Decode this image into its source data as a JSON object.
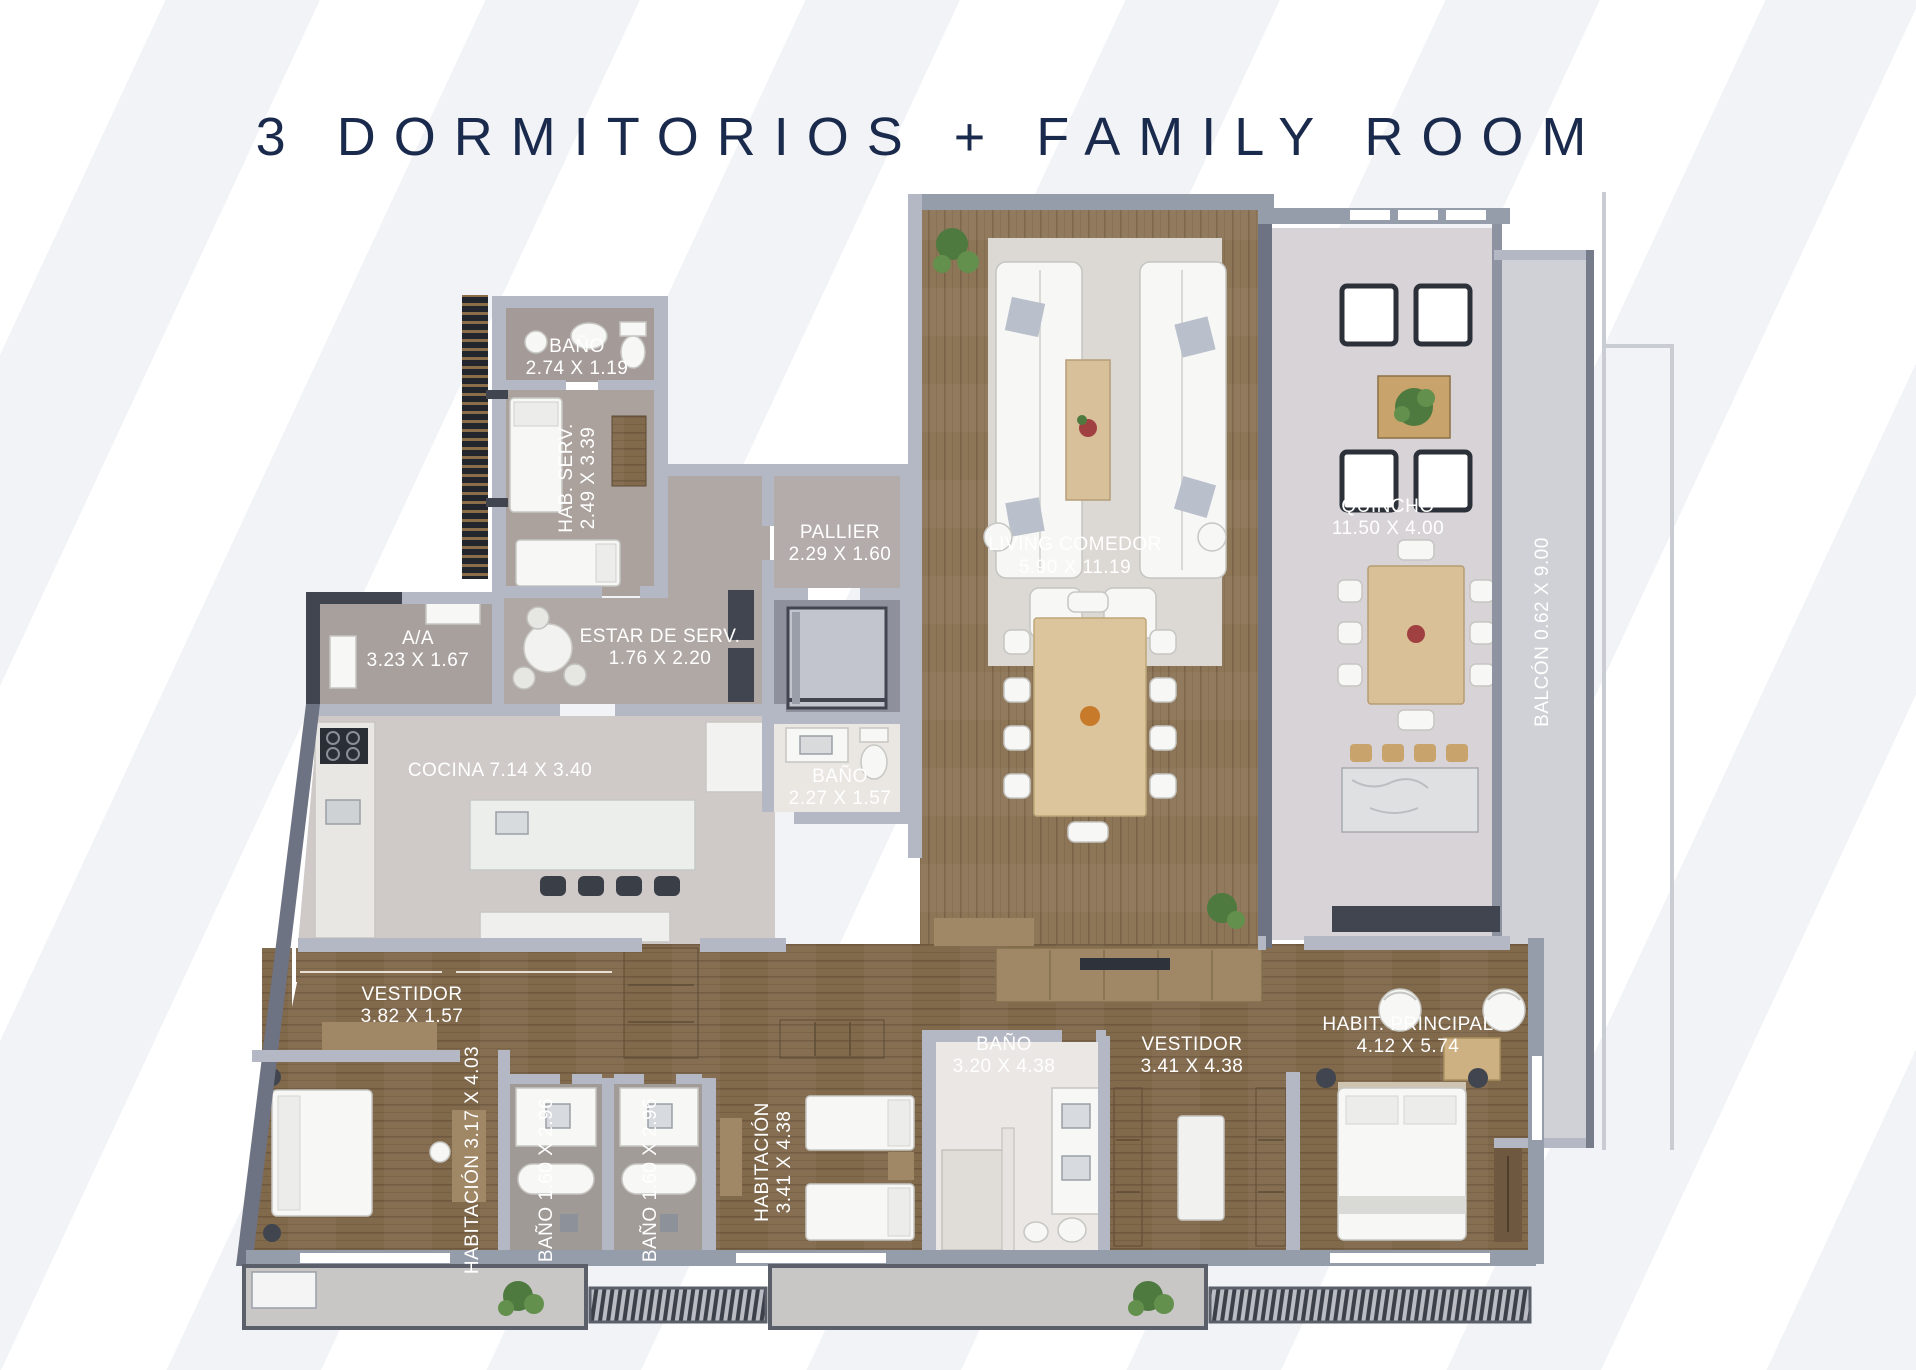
{
  "title": "3 DORMITORIOS + FAMILY ROOM",
  "colors": {
    "title_text": "#1a2a4c",
    "label_text": "#ffffff",
    "wood_floor": "#8d7557",
    "light_floor": "#d7d3d6",
    "stone_floor": "#cfcac8",
    "wall_light": "#b4b8c4",
    "wall_dark": "#6d7382",
    "background_stripe": "#f2f3f6"
  },
  "rooms": {
    "bano_serv": {
      "name": "BAÑO",
      "dims": "2.74 X 1.19"
    },
    "hab_serv": {
      "name": "HAB. SERV.",
      "dims": "2.49 X 3.39"
    },
    "pallier": {
      "name": "PALLIER",
      "dims": "2.29 X 1.60"
    },
    "living": {
      "name": "LIVING COMEDOR",
      "dims": "5.90 X 11.19"
    },
    "quincho": {
      "name": "QUINCHO",
      "dims": "11.50 X 4.00"
    },
    "aa": {
      "name": "A/A",
      "dims": "3.23 X 1.67"
    },
    "estar_serv": {
      "name": "ESTAR DE SERV.",
      "dims": "1.76 X 2.20"
    },
    "cocina": {
      "label": "COCINA 7.14 X 3.40"
    },
    "bano_social": {
      "name": "BAÑO",
      "dims": "2.27 X 1.57"
    },
    "balcon": {
      "label": "BALCÓN 0.62 X 9.00"
    },
    "vestidor_serv": {
      "name": "VESTIDOR",
      "dims": "3.82 X 1.57"
    },
    "habitacion_1": {
      "label": "HABITACIÓN 3.17 X 4.03"
    },
    "bano_1": {
      "label": "BAÑO 1.60 X 2.96"
    },
    "bano_2": {
      "label": "BAÑO 1.60 X 2.96"
    },
    "habitacion_2": {
      "name": "HABITACIÓN",
      "dims": "3.41 X 4.38"
    },
    "bano_principal": {
      "name": "BAÑO",
      "dims": "3.20 X 4.38"
    },
    "vestidor_principal": {
      "name": "VESTIDOR",
      "dims": "3.41 X 4.38"
    },
    "habitacion_principal": {
      "name": "HABIT. PRINCIPAL",
      "dims": "4.12 X 5.74"
    }
  }
}
